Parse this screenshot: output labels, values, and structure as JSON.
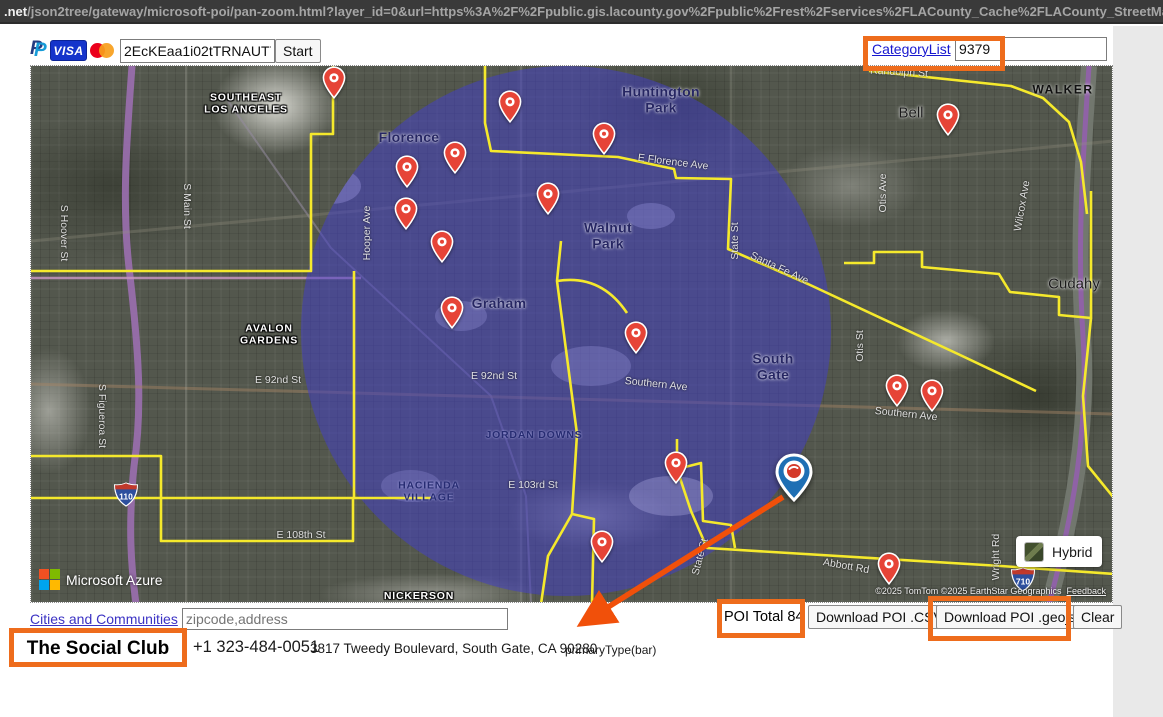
{
  "browser": {
    "url_host": ".net",
    "url_path": "/json2tree/gateway/microsoft-poi/pan-zoom.html?layer_id=0&url=https%3A%2F%2Fpublic.gis.lacounty.gov%2Fpublic%2Frest%2Fservices%2FLACounty_Cache%2FLACounty_StreetMap"
  },
  "toolbar": {
    "payment_icons": [
      "paypal-icon",
      "visa-icon",
      "mastercard-icon"
    ],
    "token_value": "2EcKEaa1i02tTRNAUT7Ez",
    "start_label": "Start",
    "category_list_label": "CategoryList",
    "category_id_value": "9379"
  },
  "map": {
    "provider": "Microsoft Azure",
    "style_button_label": "Hybrid",
    "copyright": "©2025 TomTom  ©2025 EarthStar Geographics",
    "feedback_label": "Feedback",
    "radius_circle_color": "rgba(67,62,199,0.53)",
    "boundary_color": "#f5e92c",
    "pin_color": "#e64437",
    "selected_marker": {
      "x": 793,
      "y": 470
    },
    "highway_shields": [
      {
        "label": "110",
        "x": 125,
        "y": 493
      },
      {
        "label": "710",
        "x": 1022,
        "y": 578
      }
    ],
    "pins": [
      {
        "x": 333,
        "y": 77
      },
      {
        "x": 509,
        "y": 101
      },
      {
        "x": 603,
        "y": 133
      },
      {
        "x": 454,
        "y": 152
      },
      {
        "x": 406,
        "y": 166
      },
      {
        "x": 405,
        "y": 208
      },
      {
        "x": 547,
        "y": 193
      },
      {
        "x": 441,
        "y": 241
      },
      {
        "x": 451,
        "y": 307
      },
      {
        "x": 635,
        "y": 332
      },
      {
        "x": 896,
        "y": 385
      },
      {
        "x": 931,
        "y": 390
      },
      {
        "x": 947,
        "y": 114
      },
      {
        "x": 675,
        "y": 462
      },
      {
        "x": 601,
        "y": 541
      },
      {
        "x": 888,
        "y": 563
      }
    ],
    "labels": [
      {
        "t": "Florence",
        "x": 408,
        "y": 137,
        "s": "city"
      },
      {
        "t": "Huntington\nPark",
        "x": 660,
        "y": 99,
        "s": "city"
      },
      {
        "t": "Walnut\nPark",
        "x": 607,
        "y": 235,
        "s": "city"
      },
      {
        "t": "Graham",
        "x": 498,
        "y": 303,
        "s": "city"
      },
      {
        "t": "South\nGate",
        "x": 772,
        "y": 366,
        "s": "city"
      },
      {
        "t": "Bell",
        "x": 910,
        "y": 113,
        "s": "place"
      },
      {
        "t": "Cudahy",
        "x": 1073,
        "y": 284,
        "s": "place"
      },
      {
        "t": "WALKER",
        "x": 1062,
        "y": 89,
        "s": "place-caps"
      },
      {
        "t": "SOUTHEAST\nLOS ANGELES",
        "x": 245,
        "y": 103,
        "s": "comm"
      },
      {
        "t": "AVALON\nGARDENS",
        "x": 268,
        "y": 334,
        "s": "comm"
      },
      {
        "t": "NICKERSON",
        "x": 418,
        "y": 596,
        "s": "comm"
      },
      {
        "t": "JORDAN DOWNS",
        "x": 533,
        "y": 435,
        "s": "comm-navy"
      },
      {
        "t": "HACIENDA\nVILLAGE",
        "x": 428,
        "y": 491,
        "s": "comm-navy"
      },
      {
        "t": "S Main St",
        "x": 185,
        "y": 205,
        "s": "street",
        "r": 90
      },
      {
        "t": "S Hoover St",
        "x": 62,
        "y": 232,
        "s": "street",
        "r": 90
      },
      {
        "t": "Hooper Ave",
        "x": 367,
        "y": 232,
        "s": "street",
        "r": -90
      },
      {
        "t": "S Figueroa St",
        "x": 100,
        "y": 415,
        "s": "street",
        "r": 90
      },
      {
        "t": "E 92nd St",
        "x": 277,
        "y": 380,
        "s": "street"
      },
      {
        "t": "E 92nd St",
        "x": 493,
        "y": 376,
        "s": "street"
      },
      {
        "t": "E 103rd St",
        "x": 532,
        "y": 485,
        "s": "street"
      },
      {
        "t": "E 108th St",
        "x": 300,
        "y": 535,
        "s": "street"
      },
      {
        "t": "E Florence Ave",
        "x": 672,
        "y": 162,
        "s": "street",
        "r": 7
      },
      {
        "t": "Southern Ave",
        "x": 655,
        "y": 384,
        "s": "street",
        "r": 6
      },
      {
        "t": "Southern Ave",
        "x": 905,
        "y": 414,
        "s": "street",
        "r": 6
      },
      {
        "t": "State St",
        "x": 735,
        "y": 240,
        "s": "street",
        "r": -90
      },
      {
        "t": "State St",
        "x": 700,
        "y": 556,
        "s": "street",
        "r": -75
      },
      {
        "t": "Otis St",
        "x": 860,
        "y": 345,
        "s": "street",
        "r": -90
      },
      {
        "t": "Otis Ave",
        "x": 883,
        "y": 192,
        "s": "street",
        "r": -90
      },
      {
        "t": "Wilcox Ave",
        "x": 1022,
        "y": 205,
        "s": "street",
        "r": -80
      },
      {
        "t": "Abbott Rd",
        "x": 845,
        "y": 566,
        "s": "street",
        "r": 10
      },
      {
        "t": "Wright Rd",
        "x": 996,
        "y": 556,
        "s": "street",
        "r": -90
      },
      {
        "t": "Randolph St",
        "x": 898,
        "y": 72,
        "s": "street",
        "r": 3
      },
      {
        "t": "Santa Fe Ave",
        "x": 778,
        "y": 268,
        "s": "street",
        "r": 25
      }
    ]
  },
  "bottom_bar": {
    "cities_link_label": "Cities and Communities",
    "search_placeholder": "zipcode,address",
    "poi_total_label": "POI Total 84",
    "download_csv_label": "Download POI .CSV",
    "download_geojson_label": "Download POI .geojson",
    "clear_label": "Clear"
  },
  "poi_details": {
    "name": "The Social Club",
    "phone": "+1 323-484-0051",
    "address": "3817 Tweedy Boulevard, South Gate, CA 90280",
    "primary_type": "primaryType(bar)"
  },
  "annotations": {
    "highlight_color": "#ee6c1c",
    "arrow_color": "#f1500a"
  }
}
